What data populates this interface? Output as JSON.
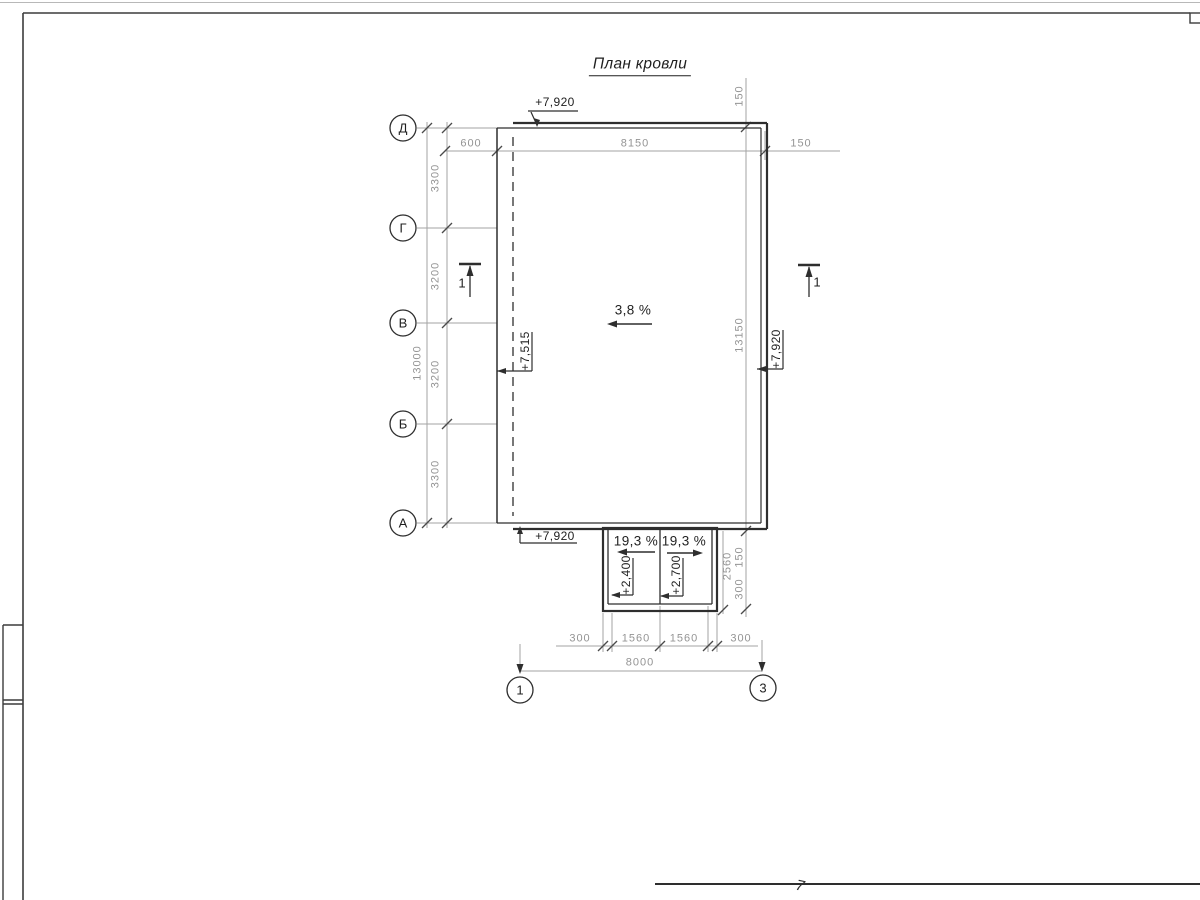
{
  "title": "План кровли",
  "grid": {
    "row_axes": [
      "Д",
      "Г",
      "В",
      "Б",
      "А"
    ],
    "col_axes": [
      "1",
      "3"
    ]
  },
  "dims": {
    "top": [
      "600",
      "8150",
      "150"
    ],
    "left_segments": [
      "3300",
      "3200",
      "3200",
      "3300"
    ],
    "left_total": "13000",
    "right_top": "150",
    "right_total": "13150",
    "right_low_150": "150",
    "right_low_300": "300",
    "right_2560": "2560",
    "bottom_segments": [
      "300",
      "1560",
      "1560",
      "300"
    ],
    "bottom_total": "8000"
  },
  "elevations": {
    "roof_top": "+7,920",
    "roof_left": "+7,515",
    "roof_right": "+7,920",
    "roof_bottom": "+7,920",
    "canopy_left": "+2,400",
    "canopy_right": "+2,700"
  },
  "slopes": {
    "main": "3,8 %",
    "canopy_left": "19,3 %",
    "canopy_right": "19,3 %"
  },
  "sections": {
    "left": "1",
    "right": "1"
  },
  "page_mark": "7",
  "colors": {
    "line_dark": "#2e2e2e",
    "line_gray": "#a3a3a3",
    "text_gray": "#949494",
    "text_dark": "#1f1f1f"
  }
}
